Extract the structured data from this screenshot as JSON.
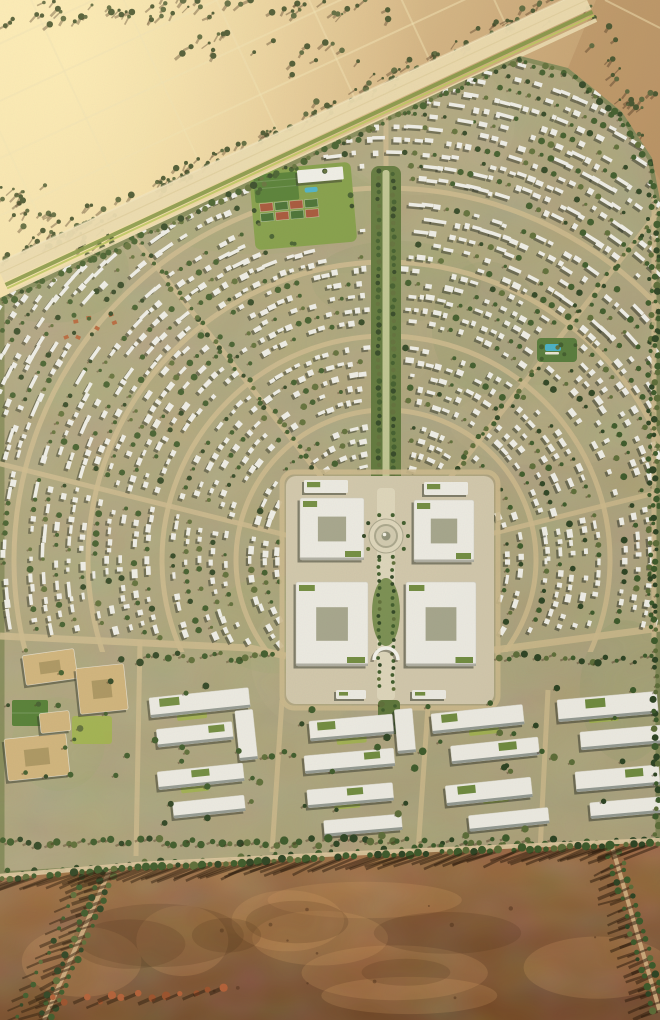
{
  "scene": {
    "type": "aerial-architectural-render",
    "canvas": {
      "width": 660,
      "height": 1020
    },
    "palette": {
      "desert_light": "#f4e1aa",
      "desert_mid": "#d9ba88",
      "desert_dark": "#c19c6d",
      "desert_far": "#b28a5c",
      "glow": "#ffedb2",
      "track": "#efdfae",
      "shrub_dark": "#42502c",
      "shrub_olive": "#57633a",
      "shrub_shadow": "rgba(58,38,20,0.38)",
      "highway_pale": "#e9d8ab",
      "highway_center": "#d8c591",
      "median_green": "#7d9140",
      "median_lime": "#b9c35a",
      "dev_ground": "#a9a077",
      "dev_light": "#b7ad84",
      "dev_dark": "#95996b",
      "road_sand": "#c9b68a",
      "edge_green": "#5f7038",
      "bldg_white": "#edece4",
      "bldg_shadow": "rgba(38,44,34,0.5)",
      "tree_dark": "#2e4424",
      "tree_mid": "#3d5a2b",
      "tree_olive": "#5c6c38",
      "lawn": "#7e9a45",
      "lawn_lime": "#9db04a",
      "field_green": "#4e7a31",
      "court_red": "#a14f35",
      "pool_blue": "#45aec4",
      "tc_base": "#cfc5a9",
      "tc_paving": "#dbd3b8",
      "tc_ring": "#a8a48a",
      "tc_dome": "#8e9077",
      "office_white": "#eae8df",
      "office_facade": "#7c837c",
      "school_tan": "#cdb078",
      "school_court": "#a8925e",
      "terracotta": "#b26038",
      "dirt_light": "#a06f3f",
      "dirt_mid": "#8a5c32",
      "dirt_dark": "#6f4522",
      "field_road": "#cfae80",
      "field_edge_road": "#dcc49c",
      "shadow_long": "rgba(42,26,12,0.5)"
    },
    "sun": {
      "building_shadow_dx": -2.2,
      "building_shadow_dy": 2.2,
      "field_shadow_dx": -28,
      "field_shadow_dy": 12
    },
    "desert": {
      "highway": {
        "x1": 587,
        "y1": 0,
        "x2": 0,
        "y2": 273
      },
      "grid": {
        "parallel_spacing": 52,
        "parallel_count": 7,
        "cross_spacing": 84,
        "cross_count": 9
      },
      "shrub_bands": [
        {
          "x1": 0,
          "y1": 14,
          "x2": 360,
          "y2": 4,
          "count": 55,
          "spread": 16
        },
        {
          "x1": 548,
          "y1": 6,
          "x2": 0,
          "y2": 258,
          "count": 115,
          "spread": 13
        },
        {
          "x1": 8,
          "y1": 190,
          "x2": 120,
          "y2": 262,
          "count": 45,
          "spread": 26
        },
        {
          "x1": 598,
          "y1": 18,
          "x2": 656,
          "y2": 150,
          "count": 26,
          "spread": 22
        },
        {
          "x1": 180,
          "y1": 60,
          "x2": 430,
          "y2": 36,
          "count": 24,
          "spread": 38
        }
      ]
    },
    "development": {
      "boundary": [
        [
          0,
          298
        ],
        [
          470,
          78
        ],
        [
          520,
          56
        ],
        [
          568,
          68
        ],
        [
          622,
          112
        ],
        [
          652,
          158
        ],
        [
          660,
          200
        ],
        [
          660,
          845
        ],
        [
          470,
          852
        ],
        [
          240,
          862
        ],
        [
          0,
          876
        ]
      ],
      "center": [
        386,
        560
      ],
      "fabric": {
        "r_min": 96,
        "r_max": 540,
        "r_step": 13,
        "spacing": 10,
        "seed": 7
      },
      "ring_road_radii": [
        150,
        224,
        298,
        372
      ],
      "radial_road_angles": [
        14,
        52,
        90,
        128,
        166
      ],
      "green_radial_angles": [
        52,
        128
      ],
      "boulevard": {
        "x": 386,
        "top": 166,
        "bottom": 512,
        "width": 30
      },
      "cross_road_left": [
        [
          0,
          636
        ],
        [
          250,
          648
        ],
        [
          286,
          656
        ]
      ],
      "cross_road_right": [
        [
          494,
          650
        ],
        [
          660,
          628
        ]
      ],
      "sports_club": {
        "x": 252,
        "y": 166,
        "w": 102,
        "h": 80
      },
      "pools": [
        {
          "x": 537,
          "y": 338,
          "w": 40,
          "h": 24
        }
      ],
      "terracotta_cluster": {
        "x": 66,
        "y": 310,
        "w": 54,
        "h": 28
      },
      "town_center": {
        "plate": [
          286,
          476,
          208,
          228
        ],
        "blocks": [
          [
            300,
            498,
            64,
            62
          ],
          [
            414,
            500,
            60,
            62
          ],
          [
            296,
            582,
            72,
            84
          ],
          [
            406,
            582,
            70,
            84
          ]
        ],
        "slabs": [
          [
            304,
            480,
            44,
            13
          ],
          [
            424,
            482,
            44,
            13
          ],
          [
            336,
            690,
            30,
            9
          ],
          [
            412,
            690,
            34,
            9
          ]
        ],
        "axis": {
          "x": 386,
          "top": 488,
          "bottom": 700,
          "width": 18
        },
        "south_green": [
          378,
          700,
          22,
          34
        ],
        "plaza": {
          "cx": 386,
          "cy": 536,
          "r": 17
        },
        "teardrop": {
          "cx": 386,
          "cy": 612,
          "rx": 14,
          "ry": 34
        },
        "arch": {
          "cx": 386,
          "cy": 660,
          "r": 12
        }
      },
      "school": {
        "buildings": [
          [
            24,
            652,
            52,
            30,
            -8
          ],
          [
            78,
            666,
            48,
            46,
            -6
          ],
          [
            6,
            736,
            62,
            42,
            -6
          ],
          [
            40,
            712,
            30,
            20,
            -6
          ]
        ],
        "fields": [
          [
            12,
            700,
            36,
            26
          ]
        ],
        "lawns": [
          [
            72,
            716,
            40,
            28
          ]
        ]
      },
      "office_campuses": [
        {
          "x": 148,
          "y": 690,
          "rot": -6,
          "slabs": [
            [
              0,
              8,
              100,
              20
            ],
            [
              4,
              40,
              76,
              18
            ],
            [
              84,
              30,
              18,
              50
            ]
          ],
          "greens": [
            [
              10,
              10,
              20,
              8
            ],
            [
              56,
              42,
              16,
              7
            ]
          ],
          "lawn": [
            26,
            14,
            30,
            20
          ]
        },
        {
          "x": 156,
          "y": 762,
          "rot": -6,
          "slabs": [
            [
              0,
              10,
              86,
              18
            ],
            [
              12,
              42,
              72,
              16
            ]
          ],
          "greens": [
            [
              34,
              12,
              18,
              7
            ]
          ],
          "lawn": [
            22,
            16,
            28,
            18
          ]
        },
        {
          "x": 300,
          "y": 712,
          "rot": -5,
          "slabs": [
            [
              8,
              10,
              84,
              20
            ],
            [
              0,
              44,
              90,
              18
            ],
            [
              94,
              6,
              18,
              44
            ]
          ],
          "greens": [
            [
              16,
              12,
              18,
              8
            ],
            [
              60,
              46,
              16,
              7
            ]
          ],
          "lawn": [
            34,
            16,
            30,
            20
          ]
        },
        {
          "x": 430,
          "y": 706,
          "rot": -6,
          "slabs": [
            [
              0,
              8,
              92,
              20
            ],
            [
              16,
              42,
              88,
              18
            ]
          ],
          "greens": [
            [
              10,
              10,
              16,
              8
            ],
            [
              64,
              44,
              18,
              8
            ]
          ],
          "lawn": [
            36,
            14,
            30,
            20
          ]
        },
        {
          "x": 556,
          "y": 690,
          "rot": -5,
          "slabs": [
            [
              0,
              10,
              100,
              22
            ],
            [
              20,
              44,
              82,
              18
            ]
          ],
          "greens": [
            [
              28,
              12,
              20,
              9
            ]
          ],
          "lawn": [
            30,
            16,
            30,
            20
          ]
        },
        {
          "x": 306,
          "y": 782,
          "rot": -5,
          "slabs": [
            [
              0,
              8,
              86,
              18
            ],
            [
              14,
              40,
              78,
              16
            ]
          ],
          "greens": [
            [
              40,
              10,
              16,
              7
            ]
          ],
          "lawn": [
            26,
            14,
            26,
            16
          ]
        },
        {
          "x": 444,
          "y": 776,
          "rot": -6,
          "slabs": [
            [
              0,
              10,
              86,
              20
            ],
            [
              20,
              42,
              80,
              16
            ]
          ],
          "greens": [
            [
              12,
              12,
              18,
              8
            ]
          ],
          "lawn": [
            36,
            16,
            26,
            16
          ]
        },
        {
          "x": 574,
          "y": 762,
          "rot": -5,
          "slabs": [
            [
              0,
              10,
              84,
              20
            ],
            [
              12,
              42,
              72,
              16
            ]
          ],
          "greens": [
            [
              50,
              12,
              18,
              8
            ]
          ],
          "lawn": [
            28,
            14,
            26,
            16
          ]
        }
      ],
      "band_roads": [
        [
          [
            140,
            640
          ],
          [
            136,
            856
          ]
        ],
        [
          [
            282,
            700
          ],
          [
            272,
            852
          ]
        ],
        [
          [
            428,
            706
          ],
          [
            418,
            852
          ]
        ],
        [
          [
            548,
            690
          ],
          [
            540,
            852
          ]
        ]
      ],
      "edge_road": {
        "x": 654,
        "top": 195,
        "bottom": 638
      }
    },
    "field": {
      "top_edge": [
        [
          0,
          878
        ],
        [
          140,
          866
        ],
        [
          340,
          856
        ],
        [
          520,
          848
        ],
        [
          660,
          842
        ]
      ],
      "roads": [
        {
          "x1": 115,
          "y1": 858,
          "x2": 44,
          "y2": 1020
        },
        {
          "x1": 612,
          "y1": 846,
          "x2": 660,
          "y2": 1012
        }
      ],
      "shrub_line": {
        "x1": 88,
        "y1": 864,
        "x2": 16,
        "y2": 1020
      },
      "orange_trees": {
        "x1": 55,
        "y1": 1002,
        "x2": 235,
        "y2": 986,
        "count": 13
      }
    }
  }
}
